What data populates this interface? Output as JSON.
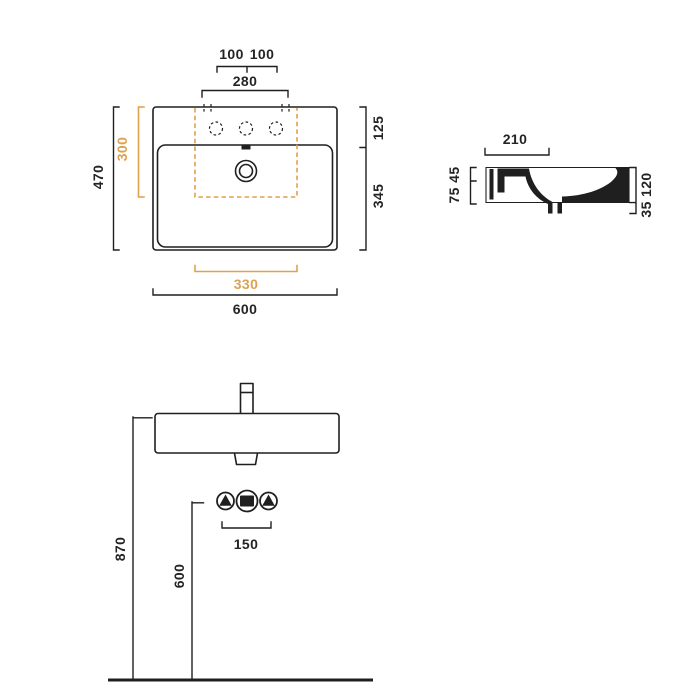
{
  "document": {
    "type": "washbasin technical drawing",
    "views": [
      "plan view",
      "side section view",
      "front elevation view"
    ]
  },
  "colors": {
    "accent_orange": "#dfa14f",
    "line_black": "#1f1f1f",
    "background": "#ffffff"
  },
  "labels": {
    "plan": {
      "tap_left": "100",
      "tap_right": "100",
      "deck_width": "280",
      "overall_depth": "470",
      "template_depth": "300",
      "rim_depth": "125",
      "basin_depth": "345",
      "template_width": "330",
      "overall_width": "600"
    },
    "side": {
      "deck_depth": "210",
      "front_heights": "75 45",
      "back_heights": "35 120"
    },
    "front": {
      "rim_height": "870",
      "connection_height": "600",
      "connection_spacing": "150"
    }
  }
}
